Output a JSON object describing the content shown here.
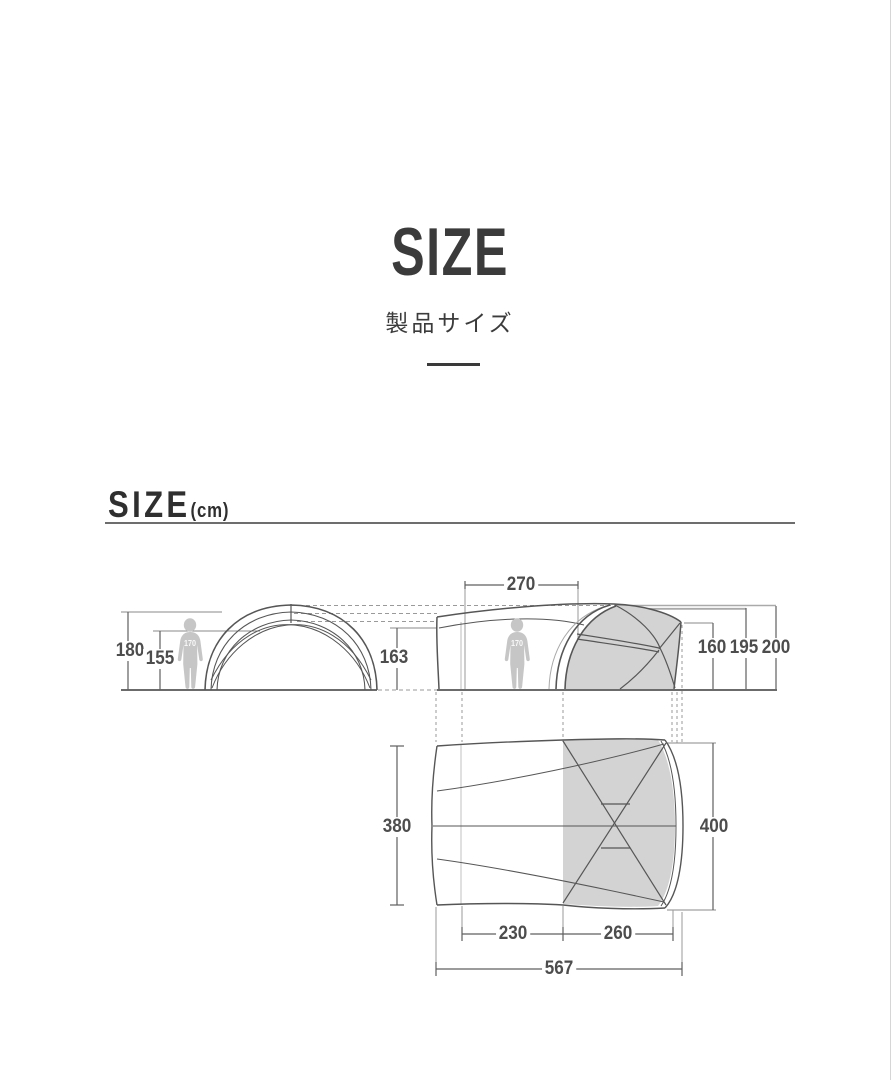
{
  "page": {
    "title": "SIZE",
    "subtitle": "製品サイズ",
    "section": {
      "heading": "SIZE",
      "unit": "(cm)"
    }
  },
  "diagram": {
    "person_height_label": "170",
    "dimensions": {
      "front_total_height": "180",
      "front_inner_height": "155",
      "side_left_height": "163",
      "canopy_top_length": "270",
      "dome_front_height": "160",
      "ridge_height": "195",
      "peak_height": "200",
      "plan_left_width": "380",
      "plan_right_width": "400",
      "canopy_floor_length": "230",
      "dome_floor_length": "260",
      "total_length": "567"
    },
    "colors": {
      "line_dark": "#555555",
      "line_light": "#999999",
      "fill_gray": "#d3d3d3",
      "person_gray": "#c6c6c6",
      "text_dark": "#3b3b3b",
      "dim_text": "#4d4d4d"
    }
  }
}
